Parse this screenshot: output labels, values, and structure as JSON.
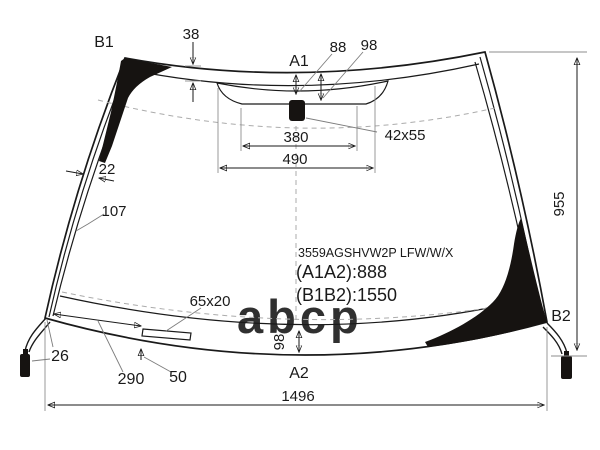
{
  "diagram": {
    "watermark": "abcp",
    "part_code": "3559AGSHVW2P LFW/W/X",
    "span_a": "(A1A2):888",
    "span_b": "(B1B2):1550",
    "points": {
      "b1": "B1",
      "a1": "A1",
      "b2": "B2",
      "a2": "A2"
    },
    "dims": {
      "top_band": "38",
      "sensor_depth_left": "88",
      "sensor_depth_right": "98",
      "shade_bottom_width": "380",
      "shade_top_width": "490",
      "sensor_size": "42x55",
      "edge_band": "22",
      "edge_offset": "107",
      "glass_height": "955",
      "bottom_band": "98",
      "glass_width": "1496",
      "connector_offset": "26",
      "button_offset_h": "290",
      "button_offset_v": "50",
      "button_size": "65x20"
    },
    "colors": {
      "ink": "#1a1a1a",
      "black_fill": "#161311",
      "watermark": "#c2c2c2",
      "dash": "#ababab",
      "extension": "#8d8d8d"
    }
  }
}
